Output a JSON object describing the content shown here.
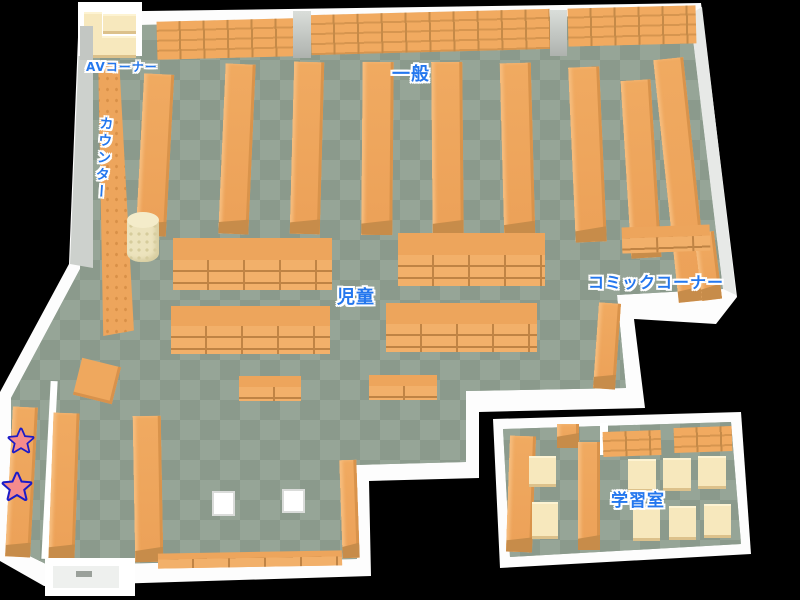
{
  "areas": {
    "av_corner": {
      "label": "AVコーナー"
    },
    "general": {
      "label": "一般"
    },
    "counter": {
      "label": "カウンター"
    },
    "children": {
      "label": "児童"
    },
    "comic_corner": {
      "label": "コミックコーナー"
    },
    "study_room": {
      "label": "学習室"
    }
  },
  "markers": {
    "star_symbol": "★",
    "star_count": 2
  },
  "colors": {
    "background": "#000000",
    "wall": "#fdfdfd",
    "floor_dark": "#8b9a8c",
    "floor_light": "#96a597",
    "shelf": "#eda55c",
    "shelf_side": "#c78c4a",
    "table": "#f7e8bd",
    "label_text": "#2477ee",
    "label_outline": "#ffffff",
    "star_fill": "#f58c8c",
    "star_outline": "#1b1bc8"
  }
}
